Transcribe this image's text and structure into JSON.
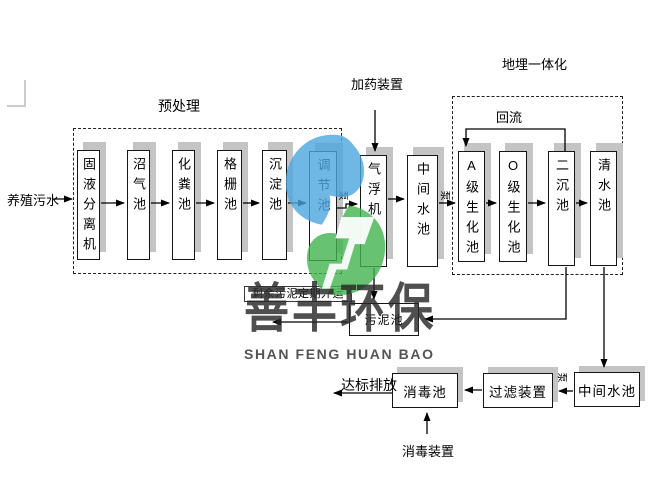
{
  "title": "养殖污水处理工艺流程图",
  "sections": {
    "pretreatment": "预处理",
    "buried_integration": "地埋一体化"
  },
  "nodes": {
    "separator": "固液分离机",
    "biogas": "沼气池",
    "septic": "化粪池",
    "grille": "格栅池",
    "sedimentation": "沉淀池",
    "regulating": "调节池",
    "air_flotation": "气浮机",
    "intermediate_top": "中间水池",
    "a_bio": "A级生化池",
    "o_bio": "O级生化池",
    "secondary_sed": "二沉池",
    "clear_water": "清水池",
    "sludge": "污泥池",
    "disinfection": "消毒池",
    "filter": "过滤装置",
    "intermediate_bottom": "中间水池"
  },
  "labels": {
    "influent": "养殖污水",
    "dosing_device": "加药装置",
    "reflux": "回流",
    "pump": "泵",
    "sludge_out": "剩余污泥定期外运",
    "discharge": "达标排放",
    "disinfection_device": "消毒装置"
  },
  "watermark": {
    "cn": "善丰环保",
    "en": "SHAN FENG HUAN BAO",
    "logo_blue": "#4BA6DF",
    "logo_green": "#41B44D"
  },
  "colors": {
    "box_border": "#151515",
    "box_shadow": "#C4C4C4",
    "line": "#000000"
  }
}
